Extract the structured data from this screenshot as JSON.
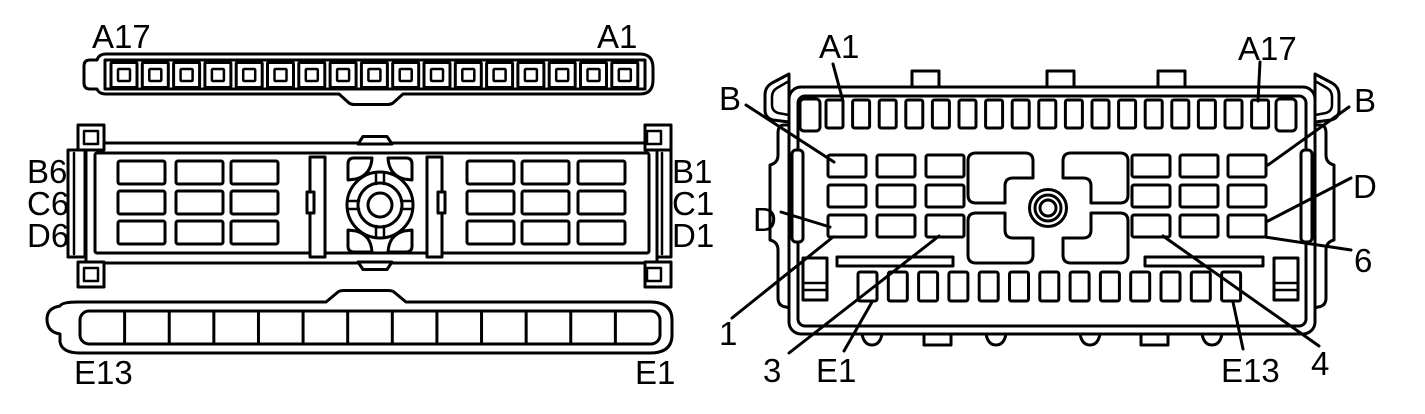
{
  "figure": {
    "background": "#ffffff",
    "line_color": "#000000",
    "views": [
      {
        "id": "face-view",
        "description": "connector face view (three housings)"
      },
      {
        "id": "terminal-view",
        "description": "connector terminal side view"
      }
    ]
  },
  "face": {
    "a_row": {
      "count": 17,
      "left_label": "A17",
      "right_label": "A1"
    },
    "bcd_rows": {
      "row_letters": [
        "B",
        "C",
        "D"
      ],
      "columns": 6,
      "left_labels": [
        "B6",
        "C6",
        "D6"
      ],
      "right_labels": [
        "B1",
        "C1",
        "D1"
      ]
    },
    "e_row": {
      "count": 13,
      "left_label": "E13",
      "right_label": "E1"
    }
  },
  "rear": {
    "a_row": {
      "count": 17,
      "first_label": "A1",
      "last_label": "A17"
    },
    "e_row": {
      "count": 13,
      "first_label": "E1",
      "last_label": "E13"
    },
    "callouts": {
      "b_left": "B",
      "b_right": "B",
      "d_left": "D",
      "d_right": "D",
      "col_1": "1",
      "col_3": "3",
      "col_4": "4",
      "col_6": "6"
    }
  }
}
